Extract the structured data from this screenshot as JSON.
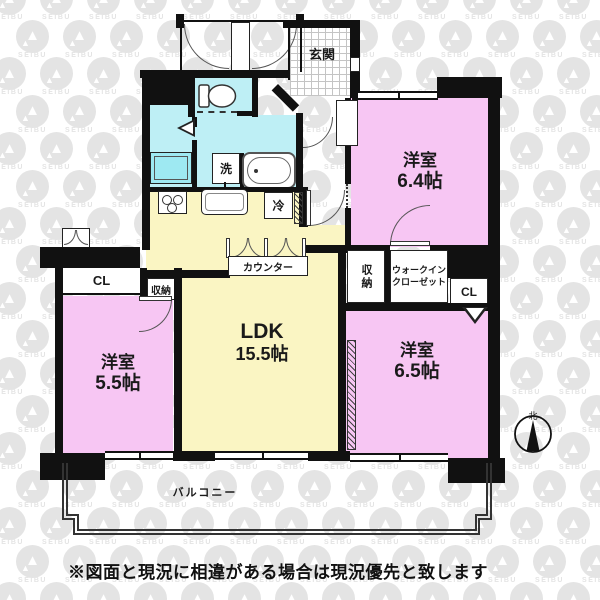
{
  "floorplan": {
    "rooms": {
      "genkan": {
        "label": "玄関"
      },
      "bedroom_64": {
        "label": "洋室",
        "size": "6.4帖"
      },
      "bedroom_65": {
        "label": "洋室",
        "size": "6.5帖"
      },
      "bedroom_55": {
        "label": "洋室",
        "size": "5.5帖"
      },
      "ldk": {
        "label": "LDK",
        "size": "15.5帖"
      },
      "balcony": {
        "label": "バルコニー"
      },
      "wic": {
        "line1": "ウォークイン",
        "line2": "クローゼット"
      },
      "closet_right": {
        "label": "CL"
      },
      "closet_left": {
        "label": "CL"
      },
      "storage_left": {
        "label": "収納"
      },
      "storage_center": {
        "label": "収納"
      },
      "counter": {
        "label": "カウンター"
      },
      "laundry": {
        "label": "洗"
      },
      "fridge": {
        "label": "冷"
      }
    },
    "compass": {
      "north_label": "北"
    },
    "watermark": {
      "text": "SEIBU"
    },
    "disclaimer": "※図面と現況に相違がある場合は現況優先と致します",
    "colors": {
      "room_pink": "#F7C6F3",
      "ldk_yellow": "#FAF5C3",
      "wet_cyan": "#BEEFF5",
      "wall": "#111111",
      "watermark_gray": "#E4E4E4"
    }
  }
}
